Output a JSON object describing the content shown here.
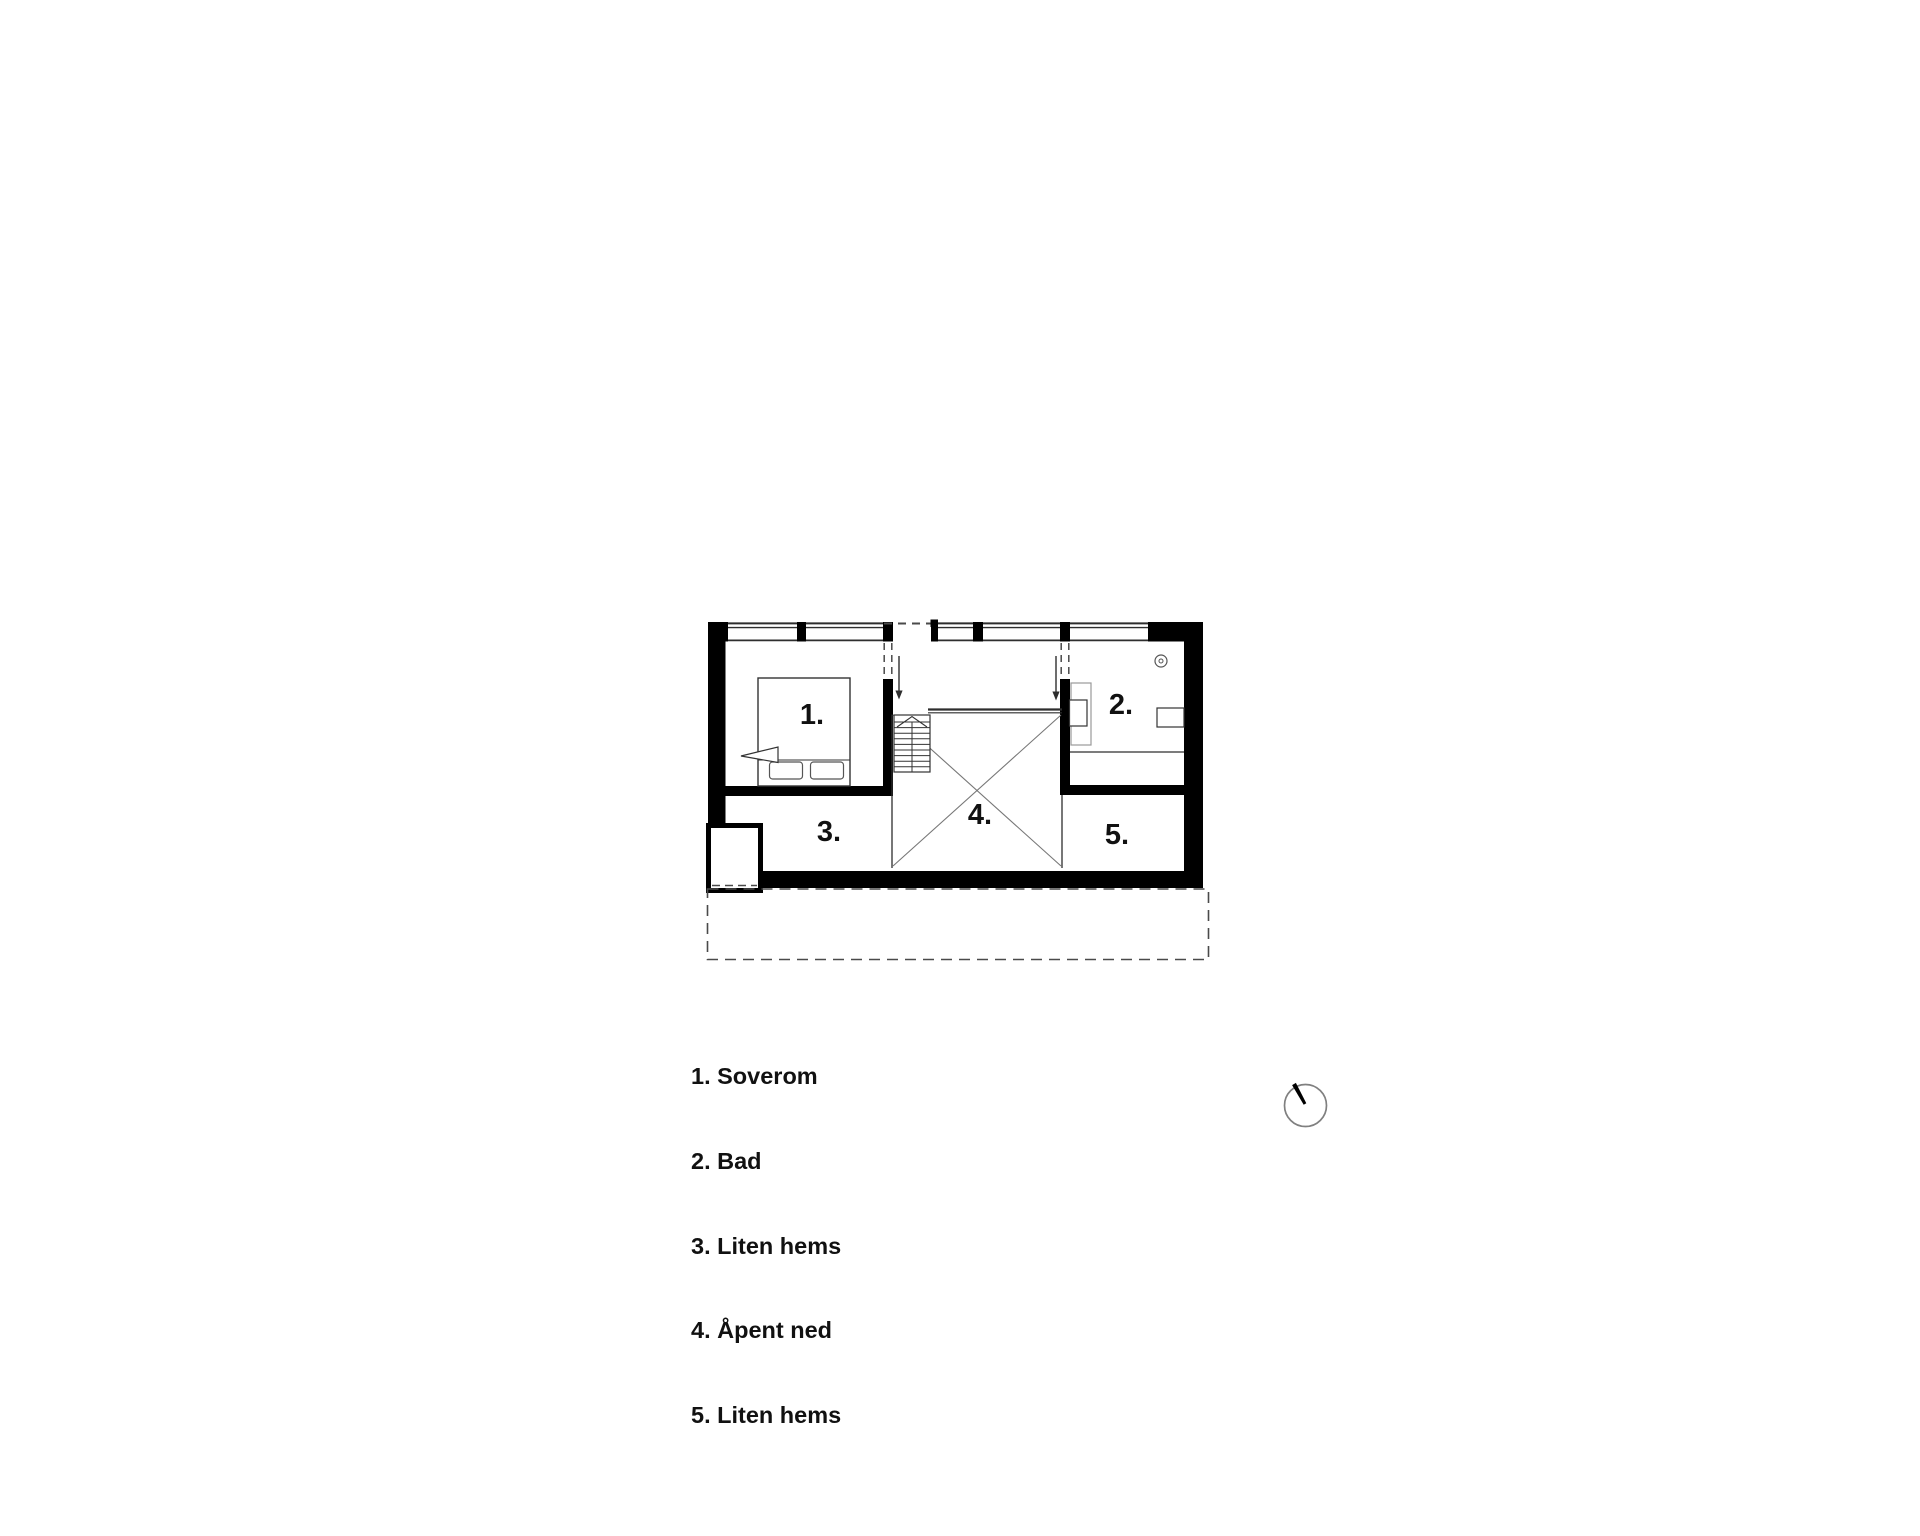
{
  "legend": {
    "items": [
      {
        "label": "1. Soverom"
      },
      {
        "label": "2. Bad"
      },
      {
        "label": "3. Liten hems"
      },
      {
        "label": "4. Åpent ned"
      },
      {
        "label": "5. Liten hems"
      }
    ]
  },
  "plan": {
    "room_labels": [
      {
        "label": "1."
      },
      {
        "label": "2."
      },
      {
        "label": "3."
      },
      {
        "label": "4."
      },
      {
        "label": "5."
      }
    ],
    "icons": [
      {
        "name": "north-arrow-icon"
      },
      {
        "name": "ceiling-light-icon"
      },
      {
        "name": "stairs-up-arrow-icon"
      },
      {
        "name": "down-arrow-icon"
      }
    ]
  },
  "colors": {
    "background": "#ffffff",
    "wall": "#000000",
    "line": "#2e2e2e",
    "light_line": "#777777",
    "dash": "#4a4a4a",
    "text": "#111111"
  }
}
